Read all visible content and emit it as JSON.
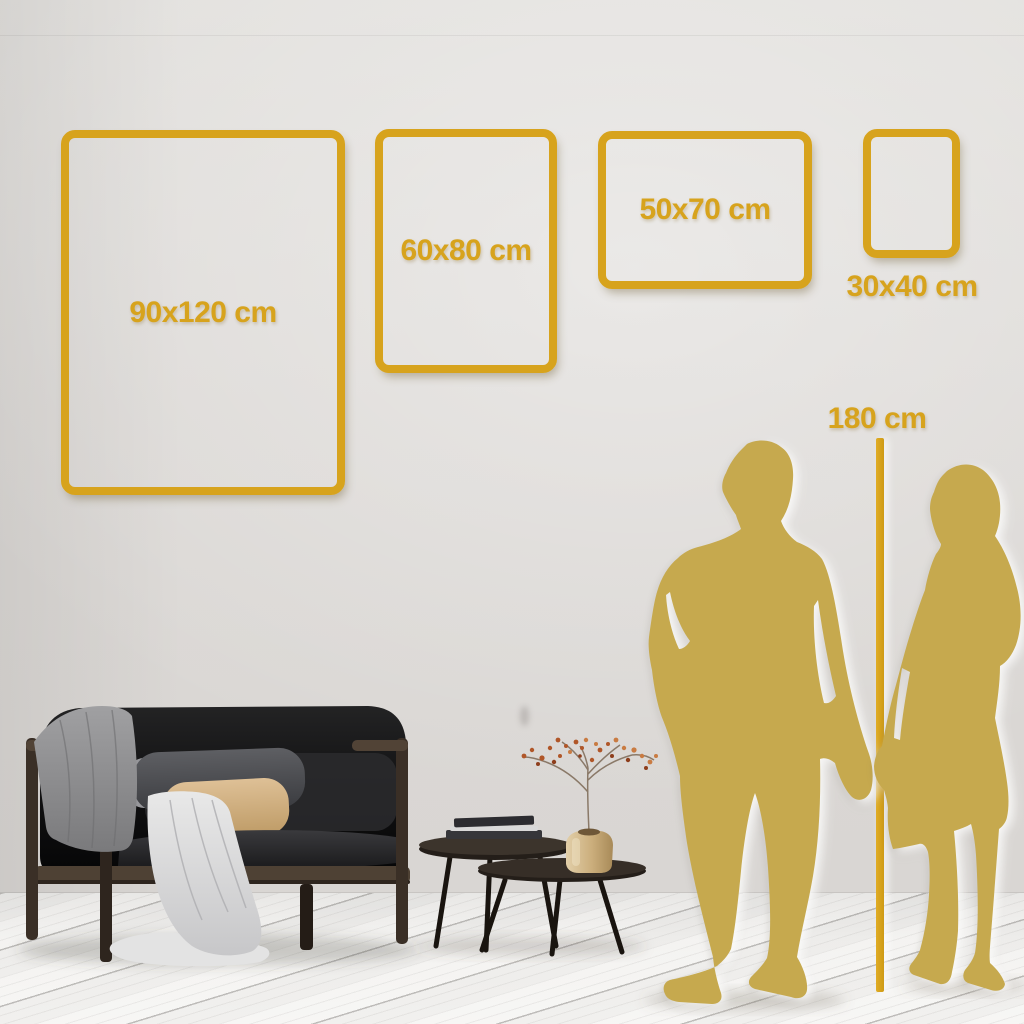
{
  "title": "Poster size guide wall mockup",
  "accent": {
    "gold": "#D7A31D",
    "silhouette_gold": "#C6A94E",
    "wall": "#DCD9D6",
    "floor": "#F3F2F0"
  },
  "frames": [
    {
      "id": "90x120",
      "label": "90x120 cm",
      "width_cm": 90,
      "height_cm": 120,
      "orientation": "portrait",
      "label_position": "inside"
    },
    {
      "id": "60x80",
      "label": "60x80 cm",
      "width_cm": 60,
      "height_cm": 80,
      "orientation": "portrait",
      "label_position": "inside"
    },
    {
      "id": "50x70",
      "label": "50x70 cm",
      "width_cm": 50,
      "height_cm": 70,
      "orientation": "landscape",
      "label_position": "inside"
    },
    {
      "id": "30x40",
      "label": "30x40 cm",
      "width_cm": 30,
      "height_cm": 40,
      "orientation": "portrait",
      "label_position": "below"
    }
  ],
  "height_reference": {
    "label": "180 cm",
    "value_cm": 180
  },
  "scene": {
    "objects": [
      "sofa",
      "gray-blanket",
      "white-throw",
      "tan-pillow",
      "dark-pillow",
      "nesting-coffee-tables",
      "books",
      "gold-vase",
      "dried-berry-plant",
      "man-silhouette",
      "woman-silhouette",
      "height-line",
      "wood-plank-floor"
    ]
  }
}
